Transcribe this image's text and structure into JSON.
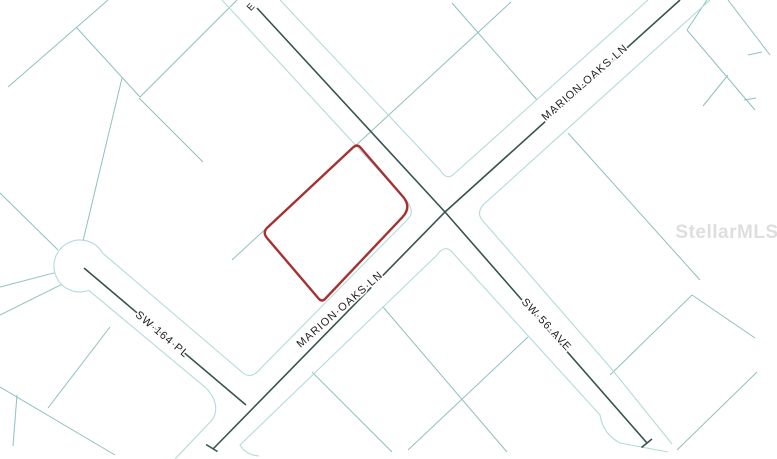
{
  "map": {
    "watermark": "StellarMLS",
    "streets": {
      "marion_oaks_upper": "MARION·OAKS·LN",
      "marion_oaks_lower": "MARION·OAKS·LN",
      "sw_164_pl": "SW·164·PL",
      "sw_56_ave": "SW·56·AVE",
      "partial_label": "E"
    },
    "colors": {
      "background": "#ffffff",
      "parcel_line": "#8fc0c0",
      "road_edge": "#b3dada",
      "centerline": "#36544f",
      "highlight": "#a63131",
      "label": "#1f1f1f",
      "watermark": "#dbdbdb"
    }
  }
}
